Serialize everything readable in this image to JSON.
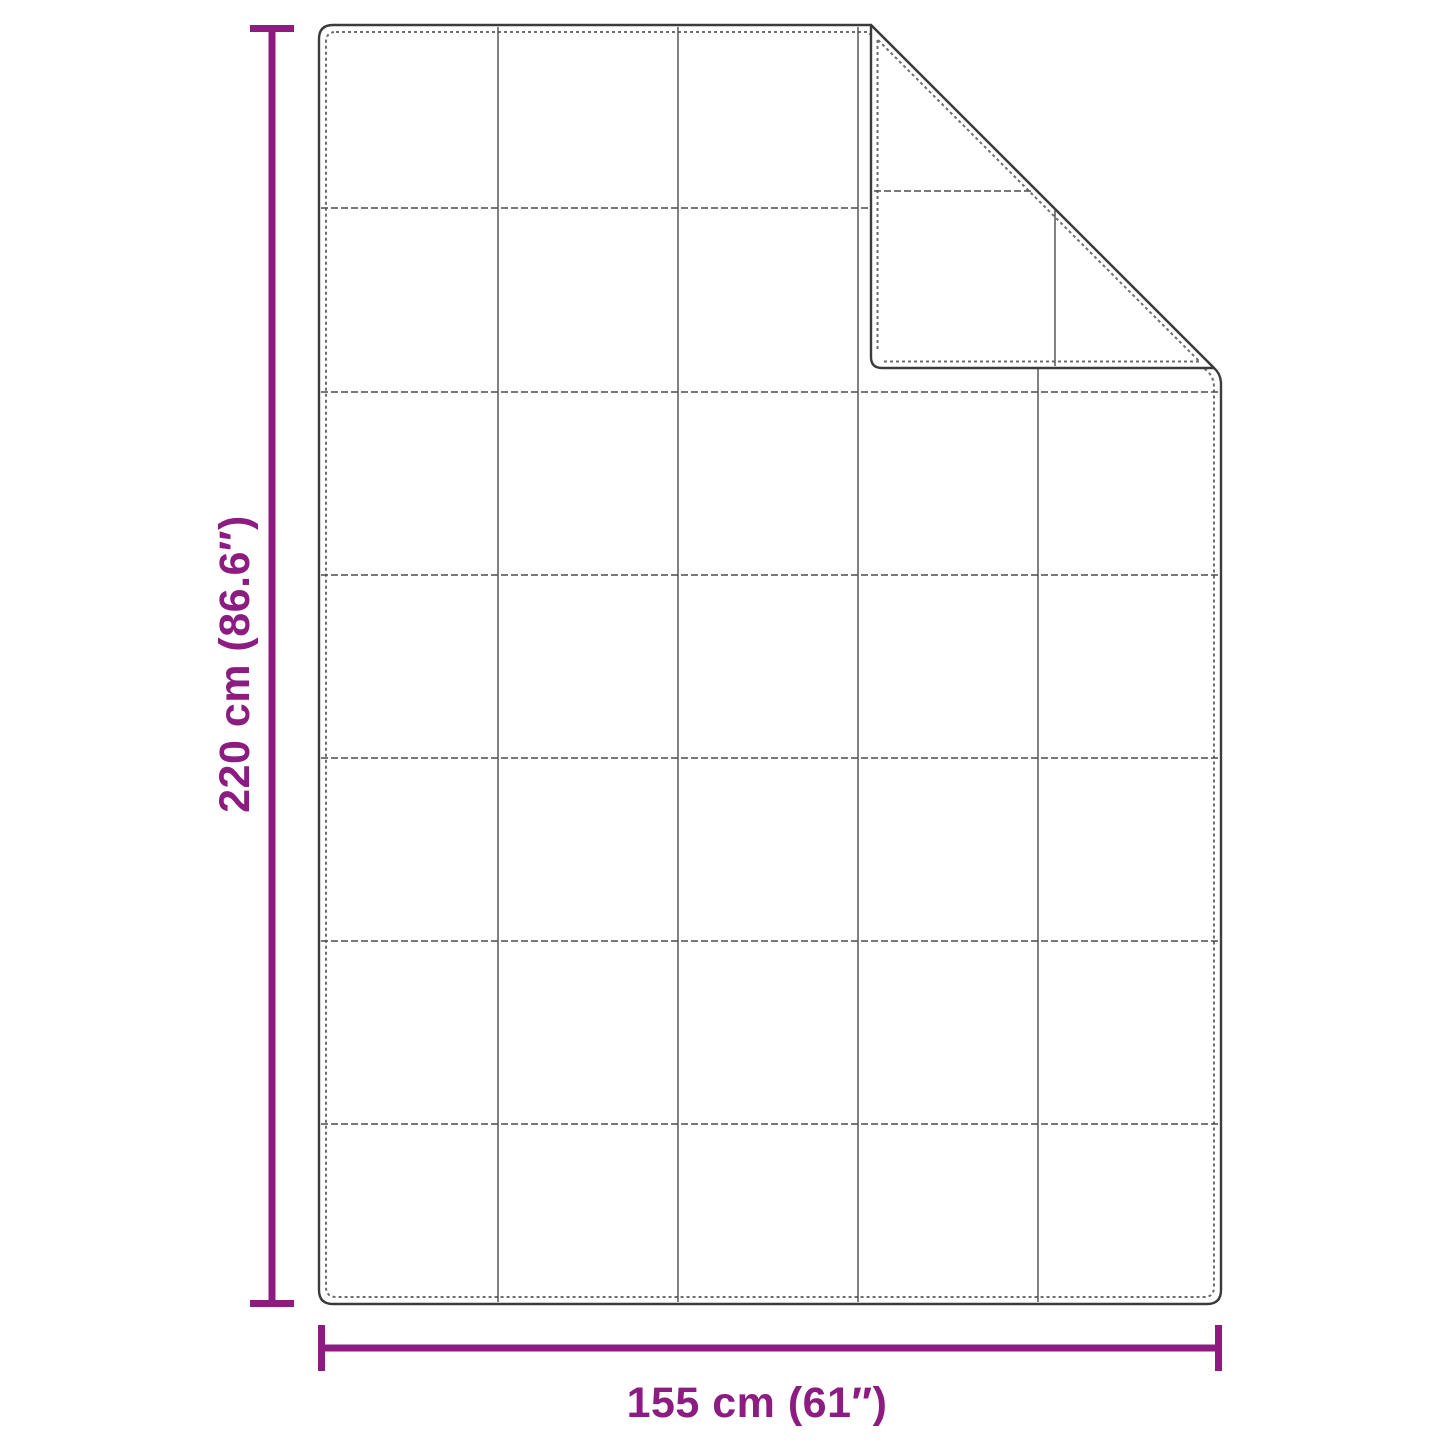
{
  "diagram": {
    "kind": "blanket-dimension-diagram",
    "height_label": "220 cm (86.6″)",
    "width_label": "155 cm (61″)",
    "height_value_cm": "220",
    "height_value_in": "86.6",
    "width_value_cm": "155",
    "width_value_in": "61",
    "accent_color": "#8d1c82",
    "outline_color": "#3b3b3b",
    "stitch_color": "#6e6e6e",
    "grid_color": "#4c4c4c",
    "grid_columns": 5,
    "grid_rows": 7
  }
}
